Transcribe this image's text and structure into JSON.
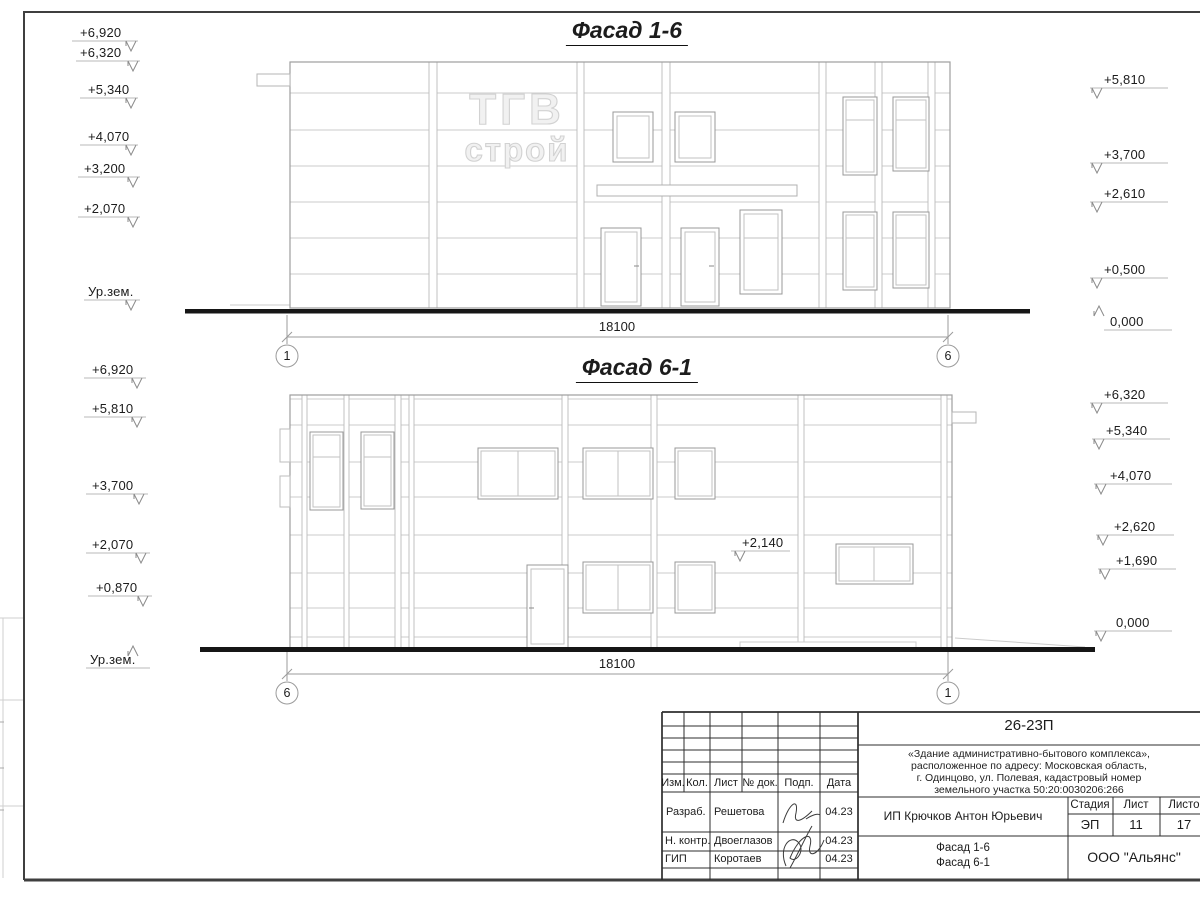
{
  "facade1": {
    "title": "Фасад 1-6",
    "dimension": "18100",
    "axis_left": "1",
    "axis_right": "6",
    "logo_line1": "ТГВ",
    "logo_line2": "строй",
    "left_marks": [
      "+6,920",
      "+6,320",
      "+5,340",
      "+4,070",
      "+3,200",
      "+2,070",
      "Ур.зем."
    ],
    "right_marks": [
      "+5,810",
      "+3,700",
      "+2,610",
      "+0,500",
      "0,000"
    ]
  },
  "facade2": {
    "title": "Фасад 6-1",
    "dimension": "18100",
    "axis_left": "6",
    "axis_right": "1",
    "annotation": "+2,140",
    "left_marks": [
      "+6,920",
      "+5,810",
      "+3,700",
      "+2,070",
      "+0,870",
      "Ур.зем."
    ],
    "right_marks": [
      "+6,320",
      "+5,340",
      "+4,070",
      "+2,620",
      "+1,690",
      "0,000"
    ]
  },
  "title_block": {
    "doc_number": "26-23П",
    "description_lines": [
      "«Здание административно-бытового комплекса»,",
      "расположенное по адресу: Московская область,",
      "г. Одинцово, ул. Полевая, кадастровый номер",
      "земельного участка 50:20:0030206:266"
    ],
    "columns": [
      "Изм.",
      "Кол.",
      "Лист",
      "№ док.",
      "Подп.",
      "Дата"
    ],
    "signature_rows": [
      {
        "role": "Разраб.",
        "name": "Решетова",
        "date": "04.23"
      },
      {
        "role": "Н. контр.",
        "name": "Двоеглазов",
        "date": "04.23"
      },
      {
        "role": "ГИП",
        "name": "Коротаев",
        "date": "04.23"
      }
    ],
    "client": "ИП Крючков Антон Юрьевич",
    "stage_label": "Стадия",
    "sheet_label": "Лист",
    "sheets_label": "Листов",
    "stage": "ЭП",
    "sheet_number": "11",
    "sheets_total": "17",
    "drawing_title_line1": "Фасад 1-6",
    "drawing_title_line2": "Фасад 6-1",
    "company": "ООО \"Альянс\""
  }
}
